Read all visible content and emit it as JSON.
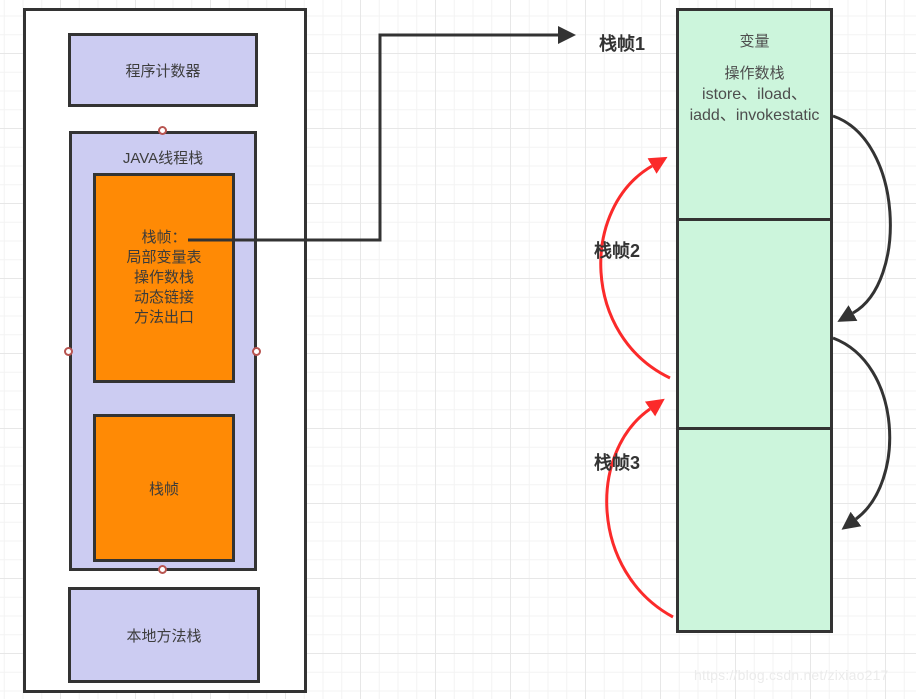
{
  "colors": {
    "box_purple": "#ccccf2",
    "box_orange": "#ff8a05",
    "box_green": "#ccf5dc",
    "border_dark": "#333333",
    "arrow_red": "#fb2a2a",
    "arrow_black": "#333333",
    "connector_point_border": "#b85450",
    "watermark_gray": "#ebebeb"
  },
  "jvm_memory": {
    "program_counter_label": "程序计数器",
    "thread_stack_label": "JAVA线程栈",
    "stack_frame_detail_lines": [
      "栈帧：",
      "局部变量表",
      "操作数栈",
      "动态链接",
      "方法出口"
    ],
    "stack_frame_label": "栈帧",
    "native_method_stack_label": "本地方法栈"
  },
  "frame_stack": {
    "frame1_label": "栈帧1",
    "frame2_label": "栈帧2",
    "frame3_label": "栈帧3",
    "frame1_content": {
      "variable_label": "变量",
      "operand_stack_label": "操作数栈",
      "instructions_line1": "istore、iload、",
      "instructions_line2": "iadd、invokestatic"
    }
  },
  "watermark": "https://blog.csdn.net/zixiao217"
}
